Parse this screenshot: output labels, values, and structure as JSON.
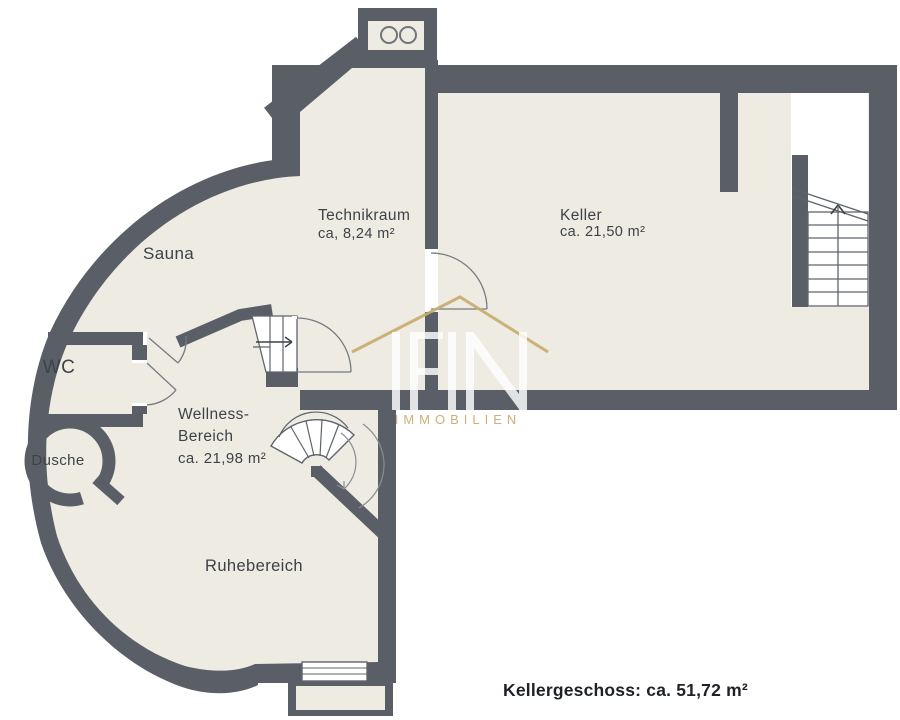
{
  "rooms": {
    "technikraum": {
      "name": "Technikraum",
      "area": "ca, 8,24 m²"
    },
    "keller": {
      "name": "Keller",
      "area": "ca. 21,50 m²"
    },
    "sauna": {
      "name": "Sauna"
    },
    "wc": {
      "name": "WC"
    },
    "dusche": {
      "name": "Dusche"
    },
    "wellness": {
      "line1": "Wellness-",
      "line2": "Bereich",
      "area": "ca. 21,98 m²"
    },
    "ruhebereich": {
      "name": "Ruhebereich"
    }
  },
  "footer": {
    "label": "Kellergeschoss: ca. 51,72 m²"
  },
  "watermark": {
    "logo": "IFIN",
    "subtitle": "IMMOBILIEN"
  },
  "colors": {
    "wall": "#5a5f67",
    "floor": "#edebe2",
    "background": "#ffffff",
    "gold": "#c7ab6d",
    "label_text": "#3d4249",
    "footer_text": "#1e2228"
  }
}
